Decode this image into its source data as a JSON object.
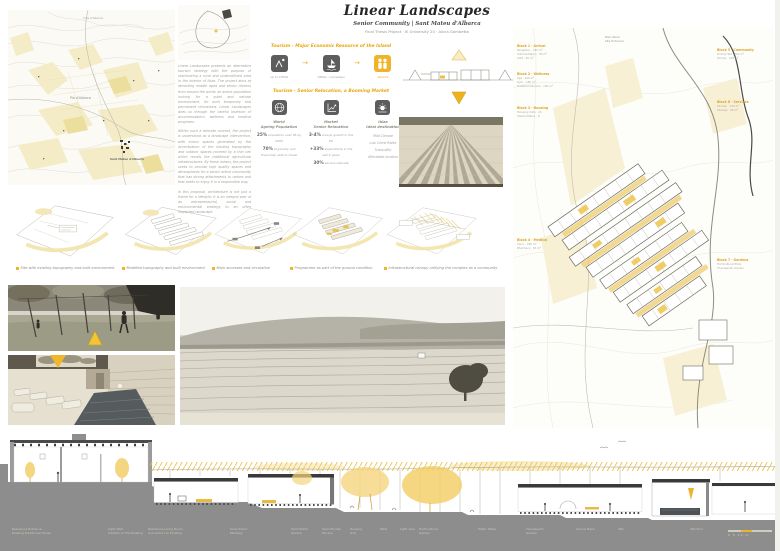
{
  "board": {
    "title": "Linear Landscapes",
    "subtitle": "Senior Community | Sant Mateu d'Albarca",
    "byline": "Final Thesis Project · IE University 20 · Alicia Gambetta"
  },
  "intro": {
    "p1": "Linear Landscapes presents an alternative tourism strategy with the purpose of reactivating a rural and underutilized area in the interior of Ibiza. The project aims at attracting middle aged and senior citizens from around the world; an active population looking for a quiet and natural environment, for both temporary and permanent relocations. Linear Landscapes does so through the careful insertion of accommodation, wellness and medical programs.",
    "p2": "Within such a delicate context, the project is understood as a landscape intervention, with indoor spaces generated by the accentuation of the existing topography and outdoor spaces covered by a thin veil which recalls the traditional agricultural infrastructures. By these means, the project seeks to provide high quality spaces and atmospheres for a senior active community that has strong attachments to nature and that seeks to enjoy it in a responsible way.",
    "p3": "In this proposal, architecture is not just a frame for a lifestyle; it is an integral part of an entrepreneurial, social and environmental strategy to an often neglected landscape."
  },
  "economy": {
    "heading": "Tourism - Major Economic Resource of the Island",
    "steps": [
      "up to 1950s",
      "1960s - nowadays",
      "seniors"
    ],
    "market_heading": "Tourism - Senior Relocation, a Booming Market",
    "columns": [
      {
        "title": "World\nAgeing Population"
      },
      {
        "title": "Market\nSenior Relocation"
      },
      {
        "title": "Ibiza\nIdeal destination"
      }
    ],
    "world_stats": [
      {
        "value": "25%",
        "text": "population over 65 by 2050"
      },
      {
        "value": "70%",
        "text": "physically and financially able to travel"
      }
    ],
    "market_stats": [
      {
        "value": "3-4%",
        "text": "annual growth in the EU"
      },
      {
        "value": "+33%",
        "text": "expenditure in the last 5 years"
      },
      {
        "value": "30%",
        "text": "seniors relocate"
      }
    ],
    "ibiza_items": "Mild Climate\nLow Crime Rates\nTranquility\nAffordable location"
  },
  "map": {
    "label_top": "Cala d'Albarca",
    "label_center": "Pla d'Albarca",
    "label_village": "Sant Mateu d'Albarca"
  },
  "process": {
    "captions": [
      "Site with existing topography and built environment",
      "Modified topography and built environment",
      "Main accesses and circulation",
      "Programme as part of the ground condition",
      "Infrastructural canopy unifying the complex as a community"
    ]
  },
  "site_plan": {
    "road_label": "Main Road\nSite Entrance",
    "blocks_left": [
      {
        "title": "Block 1 · Arrival",
        "items": "Reception · 120 m²\nAdministration · 85 m²\nCafé · 60 m²"
      },
      {
        "title": "Block 2 · Wellness",
        "items": "Spa · 420 m²\nGym · 180 m²\nTreatment Rooms · 140 m²"
      },
      {
        "title": "Block 3 · Housing",
        "items": "Housing Units · 24\nShared Patios · 8"
      },
      {
        "title": "Block 4 · Medical",
        "items": "Clinic · 260 m²\nPharmacy · 45 m²"
      }
    ],
    "blocks_right": [
      {
        "title": "Block 5 · Community",
        "items": "Dining Hall · 310 m²\nLibrary · 120 m²"
      },
      {
        "title": "Block 6 · Services",
        "items": "Kitchen · 150 m²\nStorage · 90 m²"
      },
      {
        "title": "Block 7 · Gardens",
        "items": "Horticultural Plots\nTherapeutic Garden"
      }
    ]
  },
  "section": {
    "labels": [
      "Residence Entrance\nExisting Traditional House",
      "Light Well\nAddition to the Existing",
      "Residence Living Room\nConnection to Existing",
      "Semi Public\nPathway",
      "Semi Public\nGarden",
      "Semi Private\nTerrace",
      "Housing\nUnit",
      "Patio",
      "Light well",
      "Horticultural\nGarden",
      "Public Plaza",
      "Therapeutic\nGarden",
      "Arrival Plaza",
      "SPA",
      "SPA Pool"
    ],
    "scale_label": "0   5   10 m"
  },
  "colors": {
    "accent": "#f0b42a",
    "accent_light": "#f5e3a6",
    "ink": "#5d5d5d"
  }
}
